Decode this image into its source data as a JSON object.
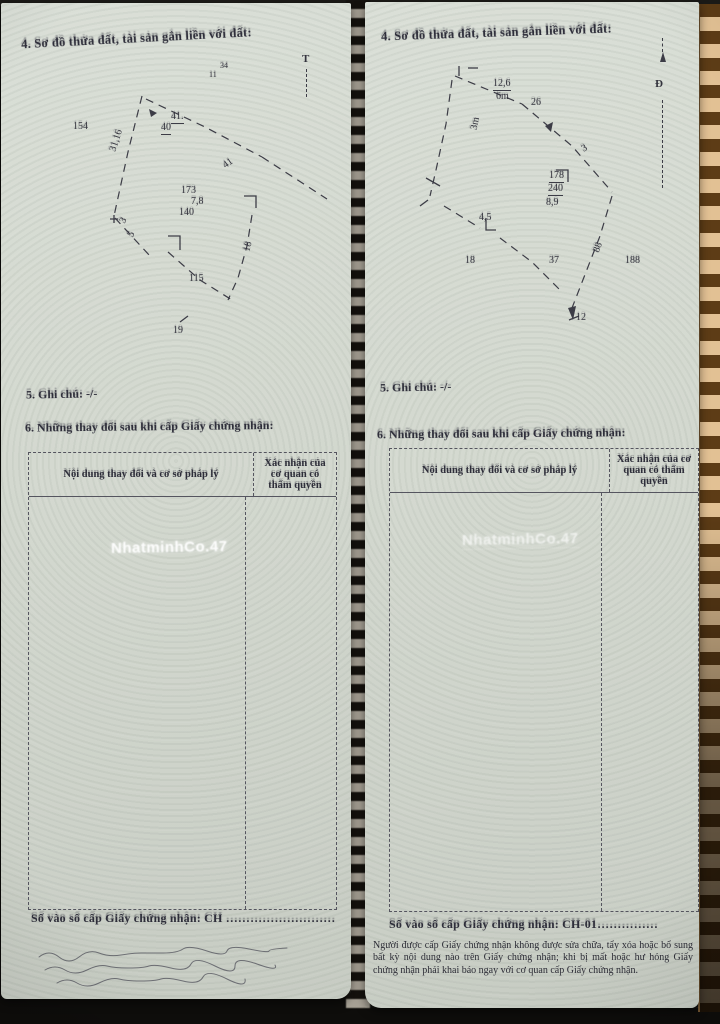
{
  "watermark_text": "NhatminhCo.47",
  "colors": {
    "paper": "#d4d9d0",
    "mat_tan": "#e2c194",
    "mat_brown": "#5d3c16",
    "ink": "#2e2e3a",
    "background": "#0e0d0b"
  },
  "page_left": {
    "heading": "4. Sơ đồ thửa đất, tài sản gắn liền với đất:",
    "north_label": "T",
    "diagram_labels": [
      {
        "t": "154",
        "x": 72,
        "y": 118
      },
      {
        "t": "31,16",
        "x": 104,
        "y": 132,
        "r": -72
      },
      {
        "t": "34",
        "x": 219,
        "y": 58,
        "s": 8
      },
      {
        "t": "11",
        "x": 208,
        "y": 67,
        "s": 8
      },
      {
        "t": "41.",
        "x": 170,
        "y": 108,
        "u": 1
      },
      {
        "t": "40",
        "x": 160,
        "y": 119,
        "u": 1
      },
      {
        "t": "41",
        "x": 222,
        "y": 155,
        "r": -35
      },
      {
        "t": "173",
        "x": 180,
        "y": 182
      },
      {
        "t": "7,8",
        "x": 190,
        "y": 193
      },
      {
        "t": "140",
        "x": 178,
        "y": 204
      },
      {
        "t": "3",
        "x": 120,
        "y": 212,
        "r": -60
      },
      {
        "t": "5",
        "x": 128,
        "y": 226,
        "r": -60
      },
      {
        "t": "18",
        "x": 242,
        "y": 238,
        "r": -75
      },
      {
        "t": "115",
        "x": 188,
        "y": 270
      },
      {
        "t": "19",
        "x": 172,
        "y": 322
      }
    ],
    "note_line": "5. Ghi chú: -/-",
    "changes_heading": "6. Những thay đổi sau khi cấp Giấy chứng nhận:",
    "table": {
      "col1": "Nội dung thay đổi và cơ sở pháp lý",
      "col2": "Xác nhận của cơ quan có thẩm quyền"
    },
    "serial_line": "Số vào sổ cấp Giấy chứng nhận: CH ………………………"
  },
  "page_right": {
    "heading": "4. Sơ đồ thửa đất, tài sản gắn liền với đất:",
    "north_label": "Đ",
    "diagram_labels": [
      {
        "t": "12,6",
        "x": 128,
        "y": 76,
        "u": 1
      },
      {
        "t": "6m",
        "x": 131,
        "y": 89
      },
      {
        "t": "26",
        "x": 166,
        "y": 95
      },
      {
        "t": "3m",
        "x": 104,
        "y": 116,
        "r": -78
      },
      {
        "t": "3",
        "x": 217,
        "y": 141,
        "r": -30
      },
      {
        "t": "178",
        "x": 184,
        "y": 168,
        "u": 1
      },
      {
        "t": "240",
        "x": 183,
        "y": 181,
        "u": 1
      },
      {
        "t": "8,9",
        "x": 181,
        "y": 195
      },
      {
        "t": "4,5",
        "x": 114,
        "y": 210
      },
      {
        "t": "18",
        "x": 100,
        "y": 253
      },
      {
        "t": "37",
        "x": 184,
        "y": 253
      },
      {
        "t": "188",
        "x": 260,
        "y": 253
      },
      {
        "t": "88",
        "x": 228,
        "y": 240,
        "r": -70
      },
      {
        "t": "12",
        "x": 211,
        "y": 310
      }
    ],
    "note_line": "5. Ghi chú: -/-",
    "changes_heading": "6. Những thay đổi sau khi cấp Giấy chứng nhận:",
    "table": {
      "col1": "Nội dung thay đổi và cơ sở pháp lý",
      "col2": "Xác nhận của cơ quan có thẩm quyền"
    },
    "serial_line": "Số vào sổ cấp Giấy chứng nhận: CH-01……………",
    "fine_print": "Người được cấp Giấy chứng nhận không được sửa chữa, tẩy xóa hoặc bổ sung bất kỳ nội dung nào trên Giấy chứng nhận; khi bị mất hoặc hư hỏng Giấy chứng nhận phải khai báo ngay với cơ quan cấp Giấy chứng nhận."
  }
}
